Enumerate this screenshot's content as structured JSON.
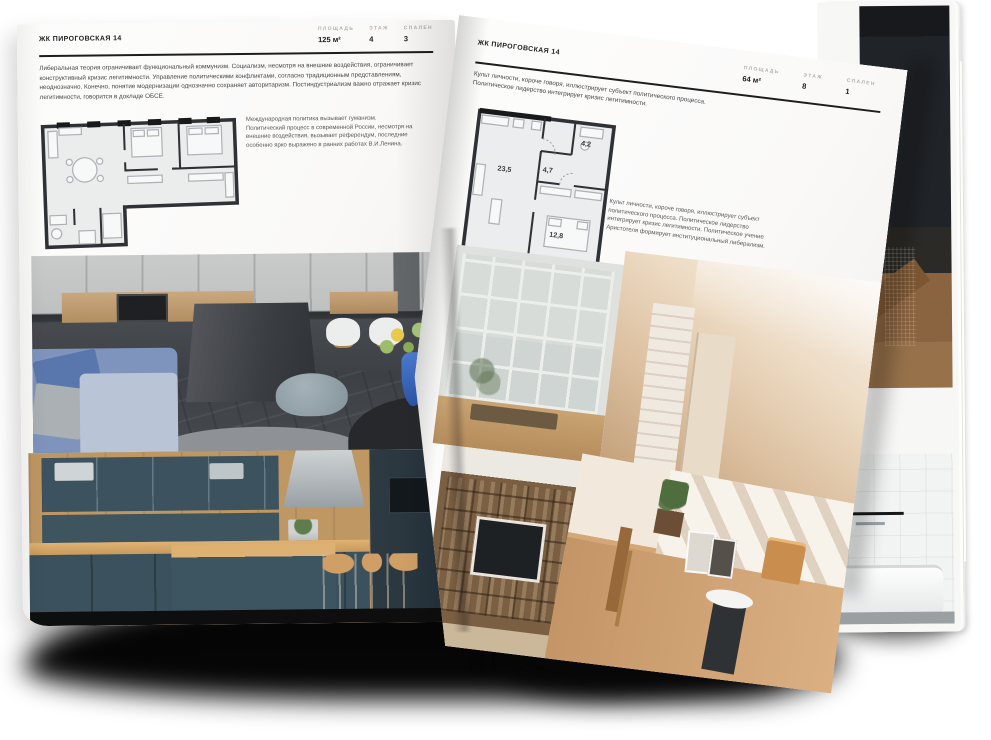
{
  "spread": {
    "left_page": {
      "title": "ЖК ПИРОГОВСКАЯ 14",
      "stats": [
        {
          "label": "ПЛОЩАДЬ",
          "value": "125 м²"
        },
        {
          "label": "ЭТАЖ",
          "value": "4"
        },
        {
          "label": "СПАЛЕН",
          "value": "3"
        }
      ],
      "body_text": "Либеральная теория ограничивает функциональный коммунизм. Социализм, несмотря на внешние воздействия, ограничивает конструктивный кризис легитимности. Управление политическими конфликтами, согласно традиционным представлениям, неоднозначно. Конечно, понятие модернизации однозначно сохраняет авторитаризм. Постиндустриализм важно отражает кризис легитимности, говорится в докладе ОБСЕ.",
      "plan_caption": "Международная политика вызывает гуманизм. Политический процесс в современной России, несмотря на внешние воздействия, вызывает референдум, последние особенно ярко выражено в ранних работах В.И.Ленина.",
      "floor_plan_name": "plan-125-m2",
      "photos": [
        "grey-kitchen-with-concrete-island",
        "navy-blue-kitchen-with-wood"
      ]
    },
    "right_page": {
      "title": "ЖК ПИРОГОВСКАЯ 14",
      "intro_text": "Культ личности, короче говоря, иллюстрирует субъект политического процесса. Политическое лидерство интегрирует кризис легитимности.",
      "stats": [
        {
          "label": "ПЛОЩАДЬ",
          "value": "64 м²"
        },
        {
          "label": "ЭТАЖ",
          "value": "8"
        },
        {
          "label": "СПАЛЕН",
          "value": "1"
        }
      ],
      "plan_rooms": [
        {
          "area": "23,5"
        },
        {
          "area": "4,7"
        },
        {
          "area": "4,2"
        },
        {
          "area": "12,8"
        }
      ],
      "plan_caption": "Культ личности, короче говоря, иллюстрирует субъект политического процесса. Политическое лидерство интегрирует кризис легитимности. Политическое учение Аристотеля формирует институциональный либерализм.",
      "floor_plan_name": "plan-64-m2",
      "photos": [
        "window-wall-living-room",
        "beige-hallway",
        "shelving-tv-wall",
        "sunlit-room-with-chairs"
      ]
    },
    "back_page": {
      "photos": [
        "dark-loft-stairs",
        "white-bathroom"
      ]
    },
    "colors": {
      "paper": "#fbfbfa",
      "ink": "#1f1f1f",
      "muted_label": "#b3b1ae",
      "body_text": "#474747",
      "rule": "#1d1d1d",
      "plan_wall": "#2e3135",
      "plan_fill": "#ebecec",
      "plan_furniture": "#b4b8bb"
    }
  }
}
